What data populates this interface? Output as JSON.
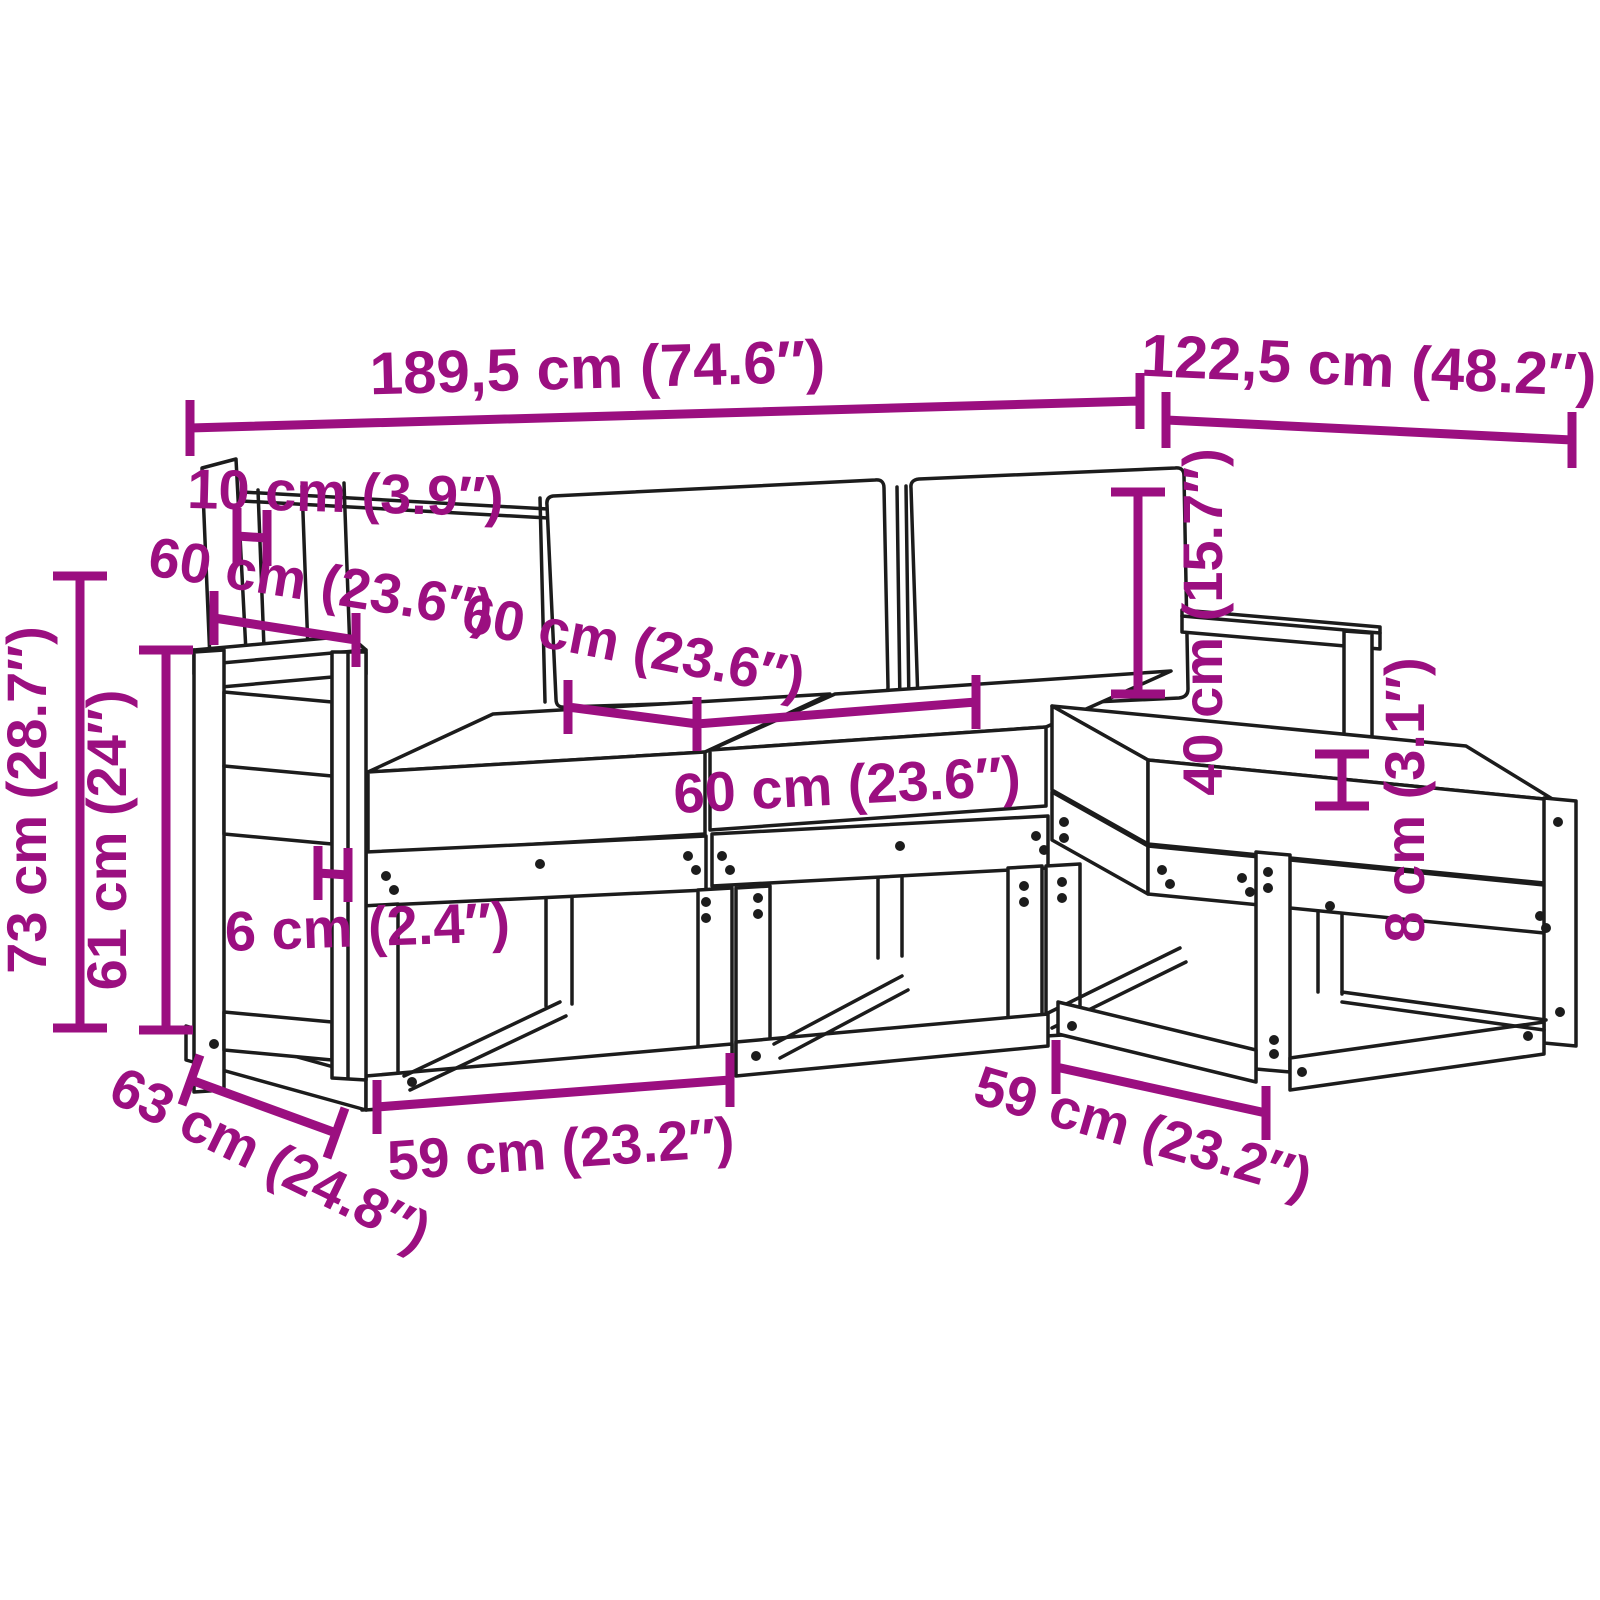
{
  "diagram": {
    "description": "Dimension diagram of a modular wooden garden sofa set with cushions",
    "units": "cm (inches)",
    "dimension_color": "#9b0f80",
    "line_color": "#1c1c1c"
  },
  "dims": {
    "overall_width": {
      "label": "189,5 cm (74.6″)",
      "cm": 189.5,
      "inch": 74.6
    },
    "overall_depth": {
      "label": "122,5 cm (48.2″)",
      "cm": 122.5,
      "inch": 48.2
    },
    "back_offset": {
      "label": "10 cm (3.9″)",
      "cm": 10,
      "inch": 3.9
    },
    "armrest_depth": {
      "label": "60 cm (23.6″)",
      "cm": 60,
      "inch": 23.6
    },
    "seat_depth": {
      "label": "60 cm (23.6″)",
      "cm": 60,
      "inch": 23.6
    },
    "seat_width": {
      "label": "60 cm (23.6″)",
      "cm": 60,
      "inch": 23.6
    },
    "total_height": {
      "label": "73 cm (28.7″)",
      "cm": 73,
      "inch": 28.7
    },
    "armrest_height": {
      "label": "61 cm (24″)",
      "cm": 61,
      "inch": 24
    },
    "backrest_height": {
      "label": "40 cm (15.7″)",
      "cm": 40,
      "inch": 15.7
    },
    "cushion_thickness": {
      "label": "8 cm (3.1″)",
      "cm": 8,
      "inch": 3.1
    },
    "frame_board_width": {
      "label": "6 cm (2.4″)",
      "cm": 6,
      "inch": 2.4
    },
    "base_depth": {
      "label": "63 cm (24.8″)",
      "cm": 63,
      "inch": 24.8
    },
    "seat_frame_width_left": {
      "label": "59 cm (23.2″)",
      "cm": 59,
      "inch": 23.2
    },
    "seat_frame_width_right": {
      "label": "59 cm (23.2″)",
      "cm": 59,
      "inch": 23.2
    }
  }
}
